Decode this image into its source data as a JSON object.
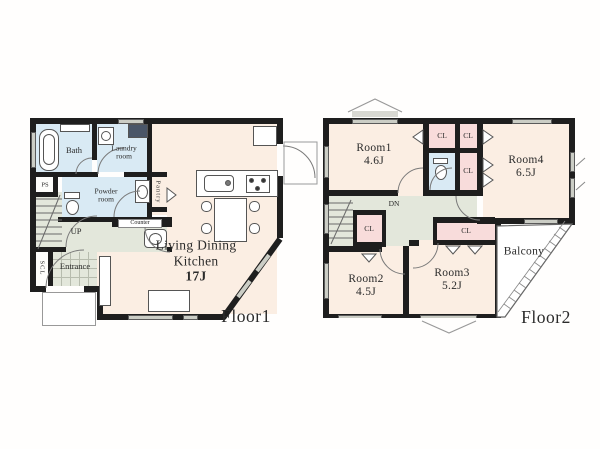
{
  "floor1": {
    "title": "Floor1",
    "bath": "Bath",
    "laundry": [
      "Laundry",
      "room"
    ],
    "powder": [
      "Powder",
      "room"
    ],
    "ps": "PS",
    "pantry": "Pantry",
    "counter": "Counter",
    "up": "UP",
    "scl": "SCL",
    "entrance": "Entrance",
    "ldk": [
      "Living Dining",
      "Kitchen",
      "17J"
    ]
  },
  "floor2": {
    "title": "Floor2",
    "room1": {
      "name": "Room1",
      "size": "4.6J"
    },
    "room2": {
      "name": "Room2",
      "size": "4.5J"
    },
    "room3": {
      "name": "Room3",
      "size": "5.2J"
    },
    "room4": {
      "name": "Room4",
      "size": "6.5J"
    },
    "cl": "CL",
    "dn": "DN",
    "balcony": "Balcony"
  },
  "colors": {
    "wall": "#1e1e1e",
    "room_fill": "#fbeee3",
    "wet_fill": "#d9eaf4",
    "closet_fill": "#f8dcdb",
    "hall_fill": "#e3e7db",
    "window_fill": "#cbcdc5",
    "tile_line": "#b7bcae"
  }
}
